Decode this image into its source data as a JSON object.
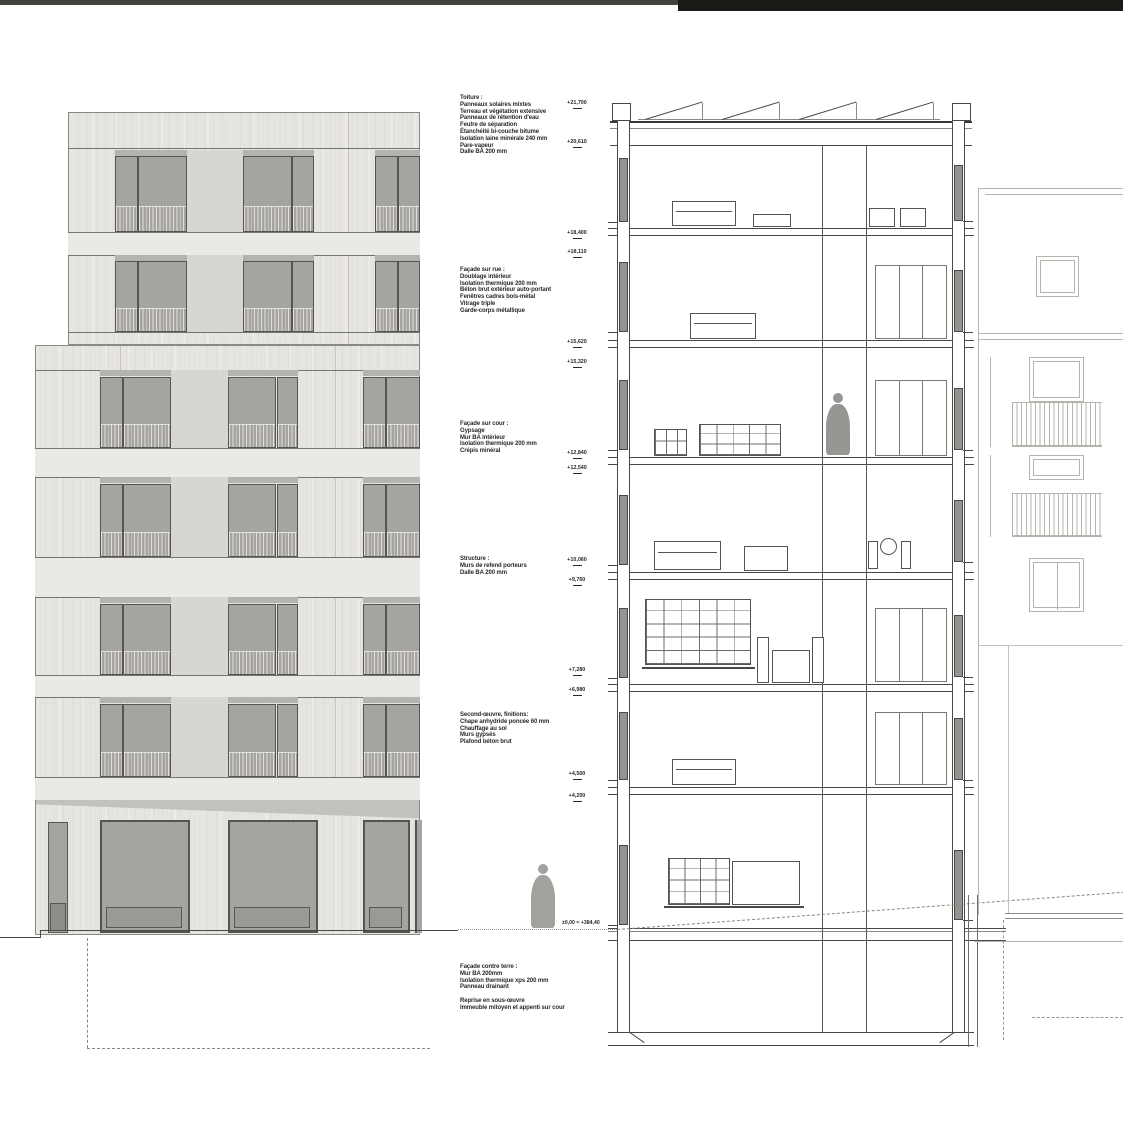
{
  "document": {
    "type": "architectural drawing sheet",
    "views": [
      "street elevation",
      "building cross-section"
    ]
  },
  "top_bars": {
    "full_bar_color": "#44423e",
    "right_bar_color": "#1b1a17"
  },
  "palette": {
    "concrete": "#e6e4df",
    "concrete_band": "#ebe9e4",
    "recess_panel": "#d8d6d0",
    "lintel": "#b5b3ae",
    "glass": "#a6a4a0",
    "window_frame": "#57554f",
    "section_line_dark": "#4a4846",
    "section_line_light": "#b7b4ae",
    "silhouette": "#9d9b97",
    "shadow": "#c3c1bb"
  },
  "annotations": {
    "toiture": {
      "title": "Toiture :",
      "lines": [
        "Panneaux solaires mixtes",
        "Terreau et végétation extensive",
        "Panneaux de rétention d'eau",
        "Feutre de séparation",
        "Étanchéité bi-couche bitume",
        "Isolation laine minérale 240 mm",
        "Pare-vapeur",
        "Dalle BA 200 mm"
      ]
    },
    "facade_rue": {
      "title": "Façade sur rue :",
      "lines": [
        "Doublage intérieur",
        "Isolation thermique 200 mm",
        "Béton brut extérieur auto-portant",
        "Fenêtres cadres bois-métal",
        "Vitrage triple",
        "Garde-corps métallique"
      ]
    },
    "facade_cour": {
      "title": "Façade sur cour :",
      "lines": [
        "Gypsage",
        "Mur BA intérieur",
        "Isolation thermique 200 mm",
        "Crépis minéral"
      ]
    },
    "structure": {
      "title": "Structure :",
      "lines": [
        "Murs de refend porteurs",
        "Dalle BA 200 mm"
      ]
    },
    "second_oeuvre": {
      "title": "Second-œuvre, finitions:",
      "lines": [
        "Chape anhydride poncée 60 mm",
        "Chauffage au sol",
        "Murs gypsés",
        "Plafond béton brut"
      ]
    },
    "facade_contre_terre": {
      "title": "Façade contre terre :",
      "lines": [
        "Mur BA 200mm",
        "Isolation thermique xps 200 mm",
        "Panneau drainant"
      ],
      "note": [
        "Reprise en sous-œuvre",
        "Immeuble mitoyen et appenti sur cour"
      ]
    }
  },
  "levels": {
    "marks": [
      {
        "value": "+21,700",
        "y": 101
      },
      {
        "value": "+20,610",
        "y": 140
      },
      {
        "value": "+18,400",
        "y": 231
      },
      {
        "value": "+18,110",
        "y": 250
      },
      {
        "value": "+15,620",
        "y": 340
      },
      {
        "value": "+15,320",
        "y": 360
      },
      {
        "value": "+12,840",
        "y": 451
      },
      {
        "value": "+12,540",
        "y": 466
      },
      {
        "value": "+10,060",
        "y": 558
      },
      {
        "value": "+9,760",
        "y": 578
      },
      {
        "value": "+7,280",
        "y": 668
      },
      {
        "value": "+6,980",
        "y": 688
      },
      {
        "value": "+4,500",
        "y": 772
      },
      {
        "value": "+4,200",
        "y": 794
      }
    ],
    "ground": "±0,00 = +384,40"
  }
}
